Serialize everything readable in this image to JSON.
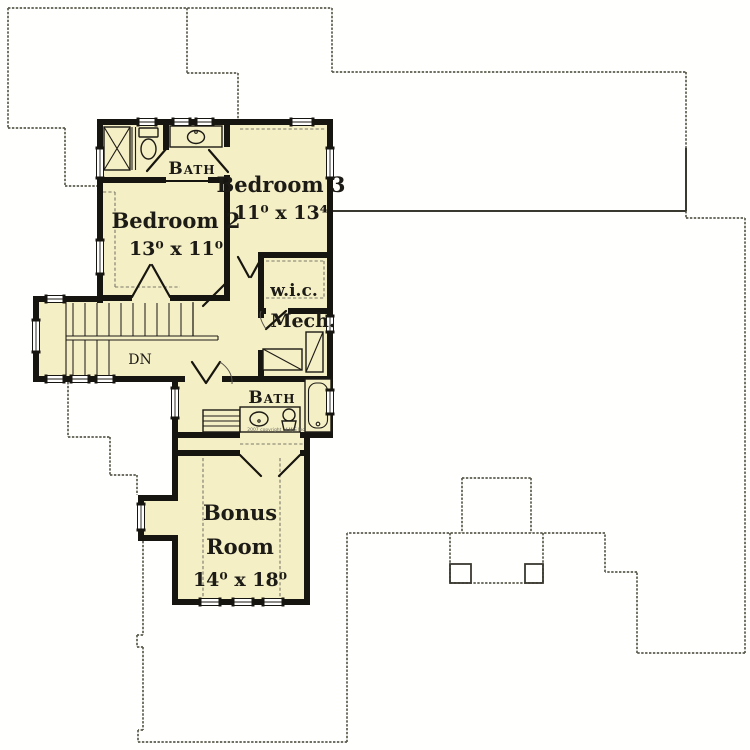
{
  "plan": {
    "colors": {
      "floor": "#f5efc5",
      "wall": "#17150f",
      "roof_outline": "#5d5c4e",
      "text": "#1d1b16"
    },
    "rooms": {
      "bedroom2": {
        "name": "Bedroom 2",
        "dims": "13⁰ x 11⁰"
      },
      "bedroom3": {
        "name": "Bedroom 3",
        "dims": "11⁰ x 13⁴"
      },
      "bonus": {
        "name": "Bonus Room",
        "name_lines": [
          "Bonus",
          "Room"
        ],
        "dims": "14⁰ x 18⁰"
      },
      "bath_upper": {
        "name": "Bath"
      },
      "bath_lower": {
        "name": "Bath"
      },
      "wic": {
        "name": "w.i.c."
      },
      "mech": {
        "name": "Mech."
      },
      "stairs": {
        "label": "DN"
      }
    },
    "copyright": "2007 copyright of MJS Inc",
    "fixtures": [
      "shower",
      "toilet",
      "sink-vanity",
      "bathtub",
      "linen-shelves",
      "water-heater",
      "hvac-unit",
      "stairs",
      "windows",
      "doors"
    ]
  }
}
